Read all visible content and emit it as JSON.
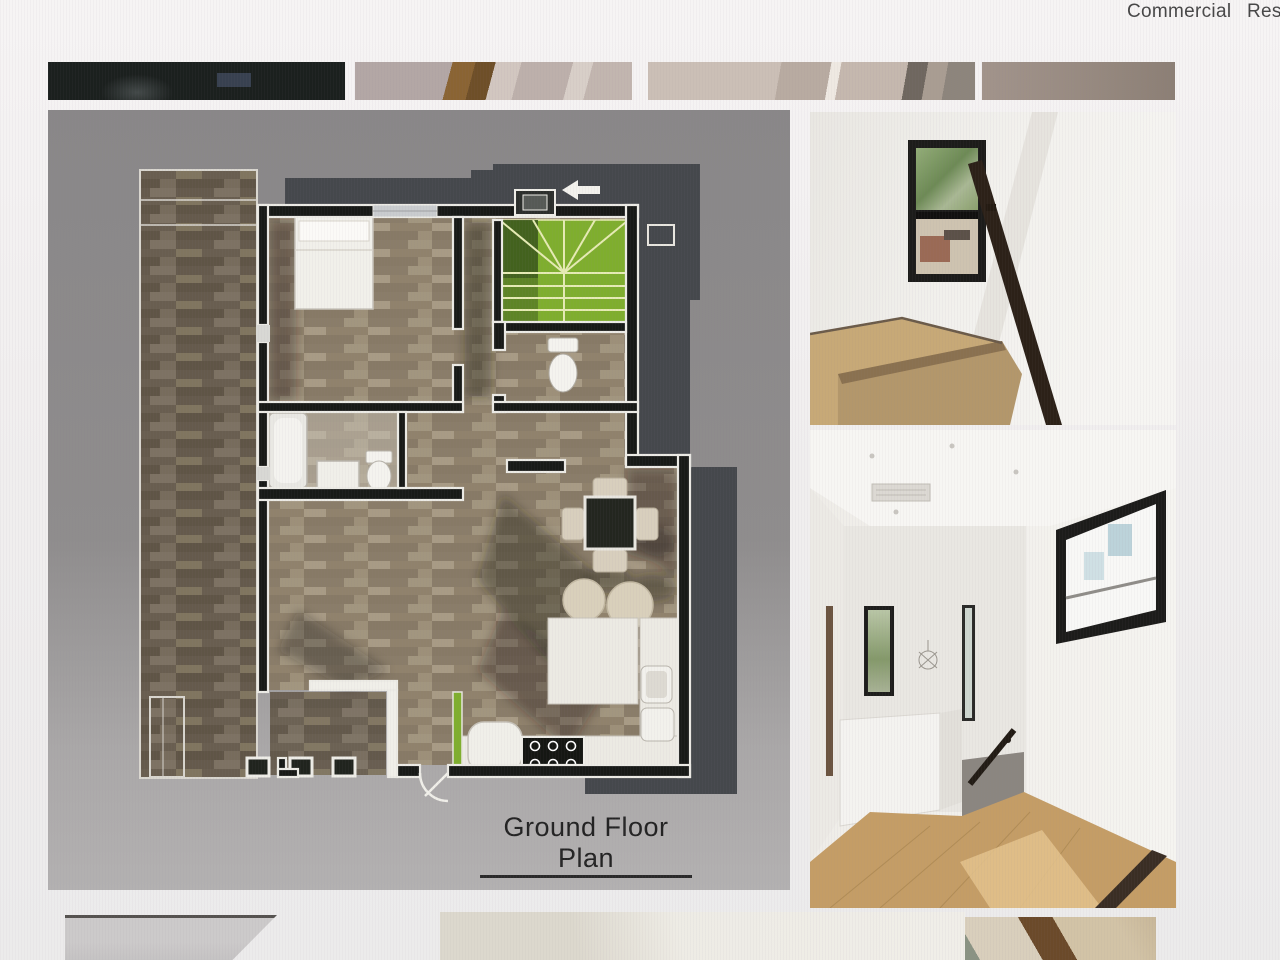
{
  "nav": {
    "items": [
      {
        "label": "Commercial"
      },
      {
        "label": "Res"
      }
    ]
  },
  "thumbnail_strip": {
    "items": [
      {
        "name": "dark-exterior-thumbnail"
      },
      {
        "name": "wood-detail-thumbnail"
      },
      {
        "name": "stair-detail-thumbnail"
      },
      {
        "name": "wall-gradient-thumbnail"
      }
    ]
  },
  "floor_plan": {
    "caption": "Ground Floor Plan",
    "colors": {
      "background": "#8d8b8b",
      "walls": "#181a17",
      "wall_outline": "#ecebe5",
      "wood_floor": "#9a8e7c",
      "deck_wood": "#706556",
      "stairs_green": "#7fae2e",
      "stairs_green_dark": "#3d5a1d",
      "roof_shadow": "#45484c",
      "counter": "#eceae3",
      "table_dark": "#23261f"
    }
  },
  "photos": {
    "top": {
      "name": "stair-landing-window-photo",
      "colors": {
        "wall": "#f0efeb",
        "wood": "#c7a977",
        "rail": "#2c2118",
        "foliage": "#7d9a64"
      }
    },
    "bottom": {
      "name": "upper-hallway-photo",
      "colors": {
        "wall": "#f1efeb",
        "wood": "#c49d66",
        "rail": "#221c15",
        "window_sky": "#cfe0e4"
      }
    }
  },
  "bottom_strip": {
    "items": [
      {
        "name": "wall-corner-partial-photo"
      },
      {
        "name": "ceiling-partial-photo"
      },
      {
        "name": "wood-beam-partial-photo"
      }
    ]
  }
}
